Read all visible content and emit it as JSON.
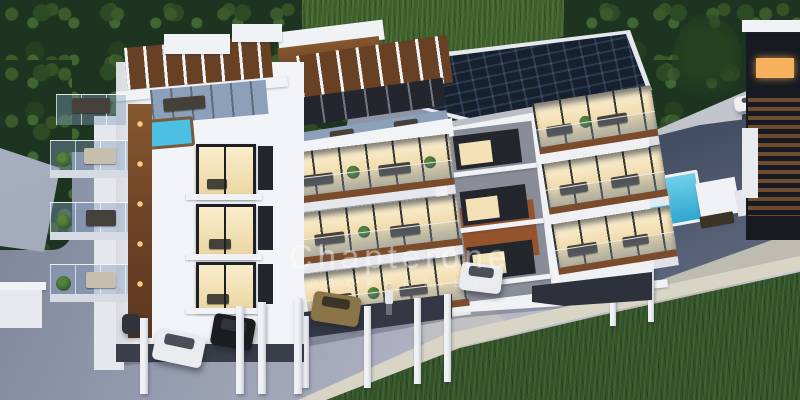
{
  "watermark": {
    "line1": "Chapterone",
    "line2": "PROPERTIES"
  },
  "scene": {
    "type": "3d-architectural-render",
    "subject": "modern-three-block-apartment-complex",
    "features": [
      "rooftop-solar-panels",
      "roof-terraces-with-pergolas",
      "hot-tub",
      "balconies-with-glass-railings",
      "warm-lit-interiors",
      "under-building-parking",
      "neighboring-pool",
      "dense-trees",
      "lawns",
      "paved-driveway"
    ],
    "building_blocks": 3,
    "residential_floors_per_block": 3,
    "vehicles_visible": 8,
    "people_visible": 3
  },
  "palette": {
    "foliage_dark": "#1d3520",
    "lawn_green": "#3e5e2e",
    "grass_bottom": "#33512a",
    "pavement": "#9aa0b3",
    "curb_concrete": "#d8d4c6",
    "building_white": "#f3f4f7",
    "wood_accent": "#6e4326",
    "rust_panel": "#95542e",
    "gray_panel": "#888d97",
    "solar_panel": "#16202e",
    "pool_water": "#3db4da",
    "warm_window_light": "#f6e6c4",
    "night_shadow": "#343845"
  }
}
